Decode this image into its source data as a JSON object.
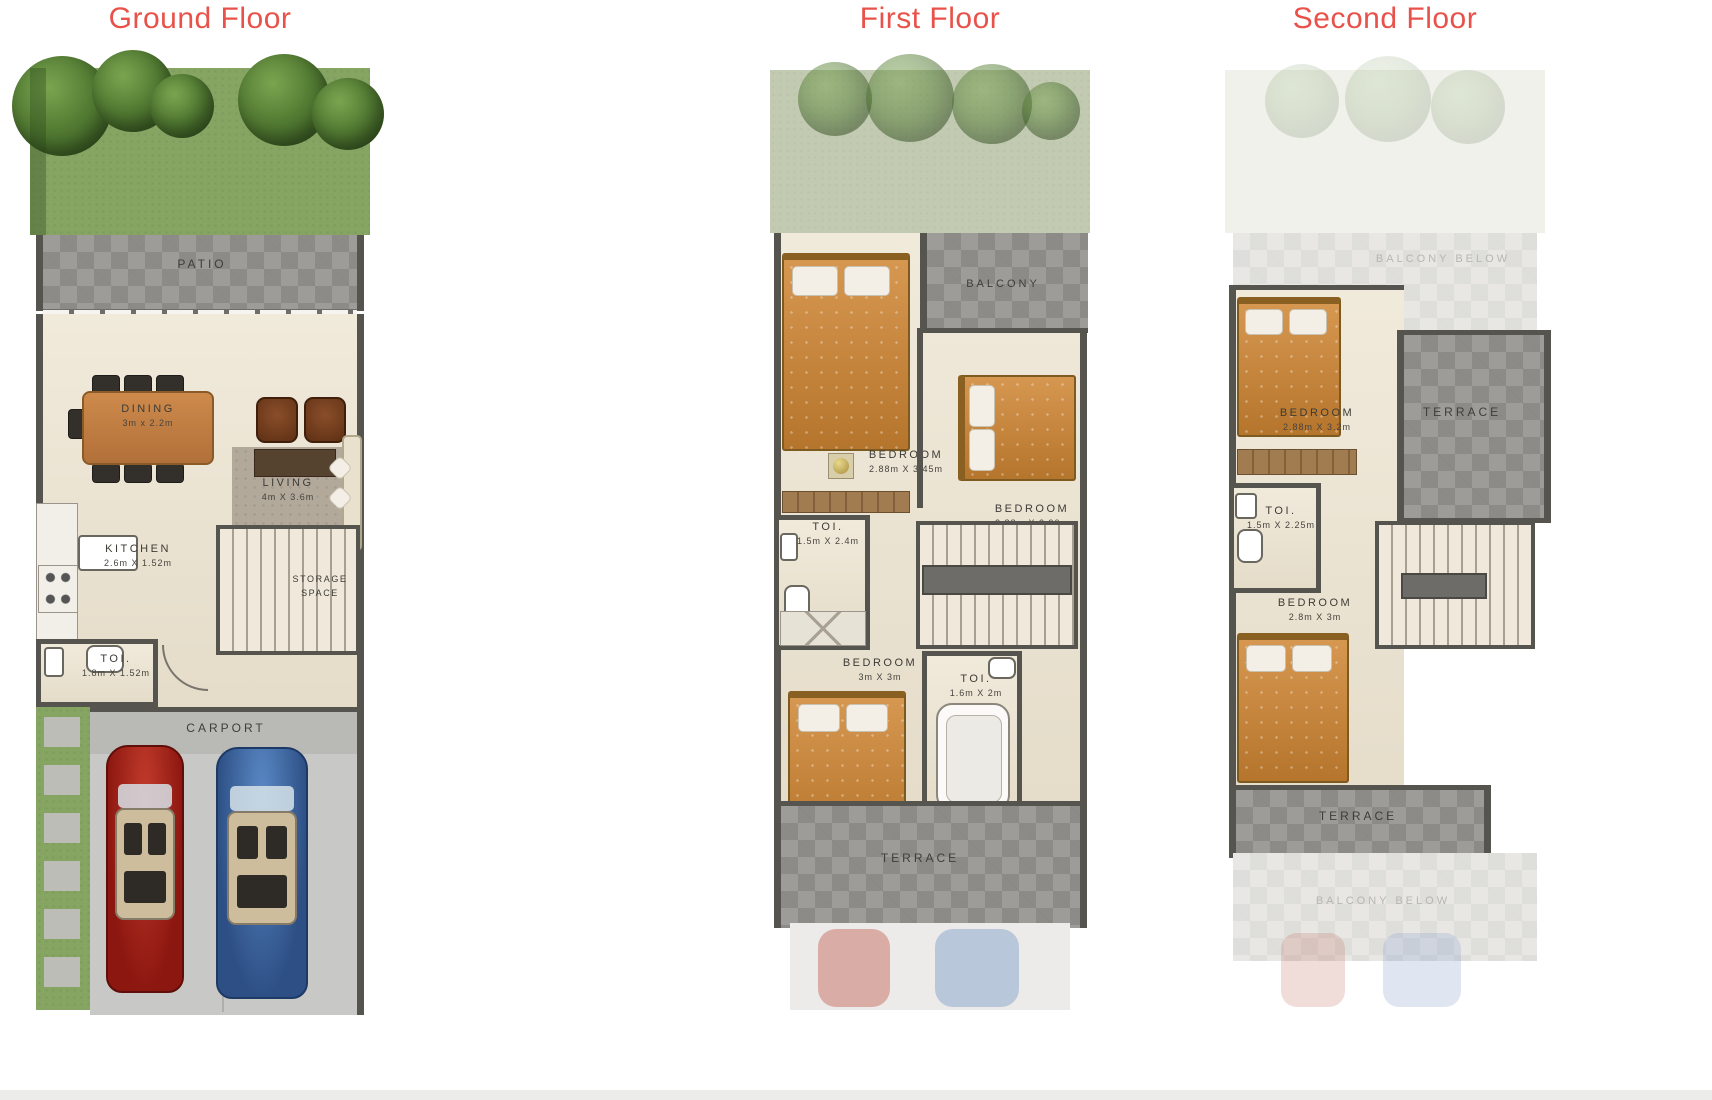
{
  "titles": {
    "ground": "Ground Floor",
    "first": "First Floor",
    "second": "Second Floor"
  },
  "colors": {
    "title_red": "#e8524a",
    "wall": "#56544e",
    "floor_cream": "#ece3cf",
    "stone_gray": "#9d9c98",
    "grass_green": "#86a563",
    "bed_orange": "#cf8532",
    "car_red": "#a11d15",
    "car_blue": "#3f72b5"
  },
  "ground": {
    "patio": "PATIO",
    "dining": {
      "name": "DINING",
      "dims": "3m x 2.2m"
    },
    "living": {
      "name": "LIVING",
      "dims": "4m X 3.6m"
    },
    "kitchen": {
      "name": "KITCHEN",
      "dims": "2.6m X 1.52m"
    },
    "storage": {
      "line1": "STORAGE",
      "line2": "SPACE"
    },
    "toi": {
      "name": "TOI.",
      "dims": "1.8m X 1.52m"
    },
    "carport": "CARPORT"
  },
  "first": {
    "balcony": "BALCONY",
    "bedroom1": {
      "name": "BEDROOM",
      "dims": "2.88m X 3.45m"
    },
    "bedroom2": {
      "name": "BEDROOM",
      "dims": "2.88m X 2.90m"
    },
    "toi1": {
      "name": "TOI.",
      "dims": "1.5m X 2.4m"
    },
    "bedroom3": {
      "name": "BEDROOM",
      "dims": "3m X 3m"
    },
    "toi2": {
      "name": "TOI.",
      "dims": "1.6m X 2m"
    },
    "terrace": "TERRACE"
  },
  "second": {
    "balcony_top": "BALCONY BELOW",
    "bedroom1": {
      "name": "BEDROOM",
      "dims": "2.88m X 3.2m"
    },
    "terrace_right": "TERRACE",
    "toi": {
      "name": "TOI.",
      "dims": "1.5m X 2.25m"
    },
    "bedroom2": {
      "name": "BEDROOM",
      "dims": "2.8m X 3m"
    },
    "terrace_bottom": "TERRACE",
    "balcony_bottom": "BALCONY BELOW"
  }
}
